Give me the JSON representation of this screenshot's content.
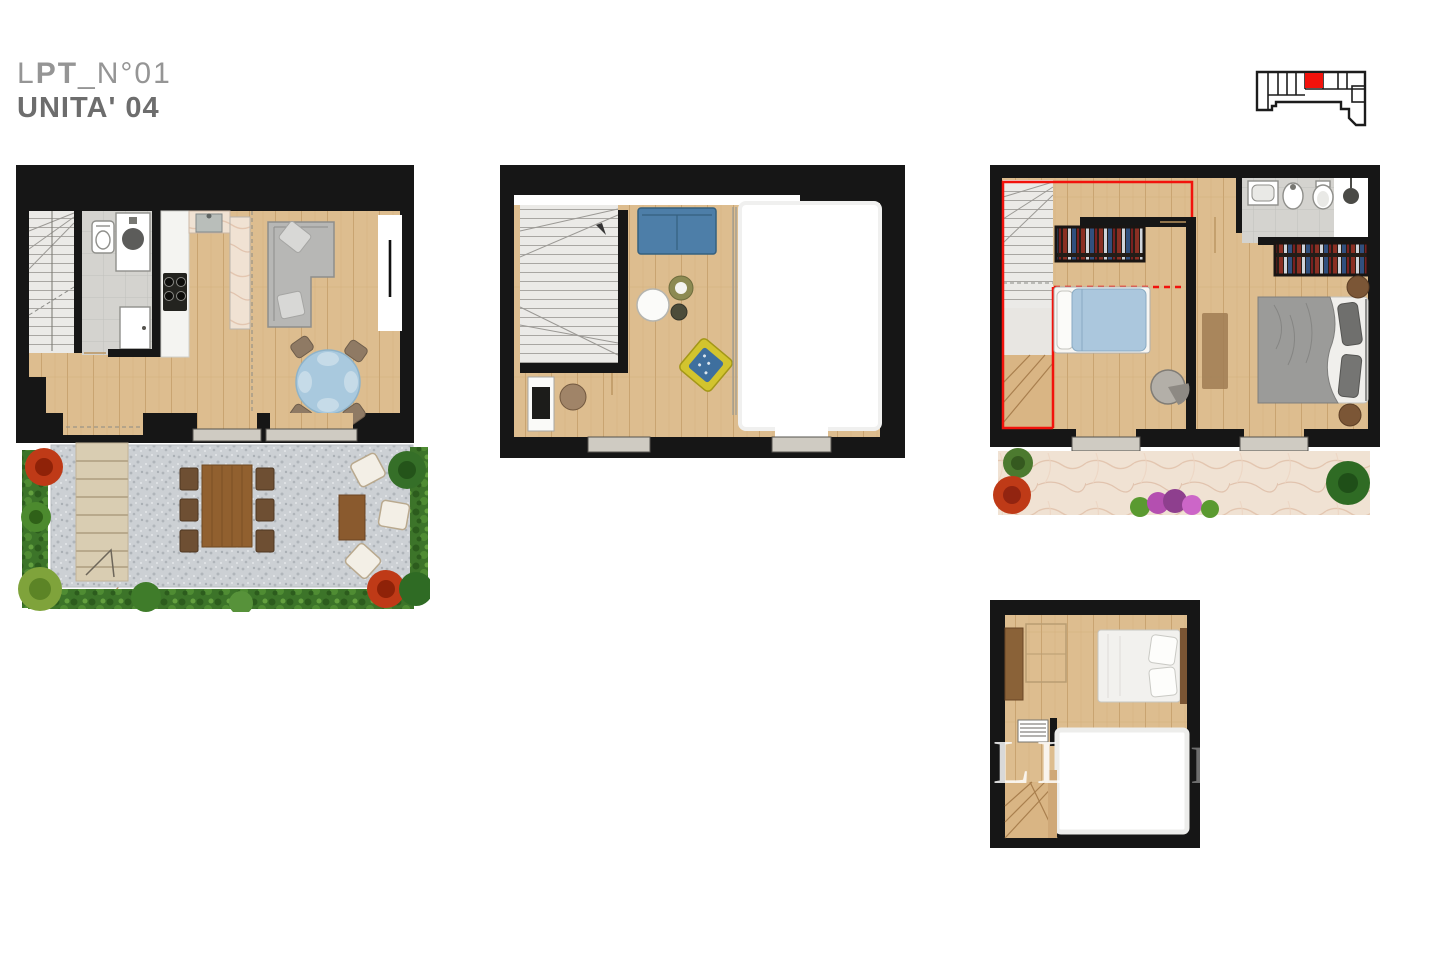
{
  "header": {
    "line1_light": "L",
    "line1_bold": "PT",
    "line1_rest": "_N°01",
    "line2": "UNITA' 04"
  },
  "keyplan": {
    "highlighted_unit_color": "#ea0c0c"
  },
  "watermark": {
    "main": "OLLO",
    "faint": "NR"
  },
  "colors": {
    "wall": "#161616",
    "wood": "#ddbd8f",
    "stair": "#ebeae7",
    "tile_gray": "#d4d3cf",
    "marble": "#f0e2d3",
    "gravel": "#ccd0d4",
    "hedge_green": "#3c7429",
    "blue_sofa": "#4d7ea8",
    "table_blue": "#a9c9de",
    "duvet_blue": "#abc7dd",
    "yellow_chair": "#d2c42e",
    "gray_sofa": "#b7b7b5",
    "garden_wood": "#91602f",
    "bush_red": "#bf3a17",
    "red": "#f2120c",
    "title_gray": "#959595",
    "subtitle_gray": "#6d6d6d"
  }
}
